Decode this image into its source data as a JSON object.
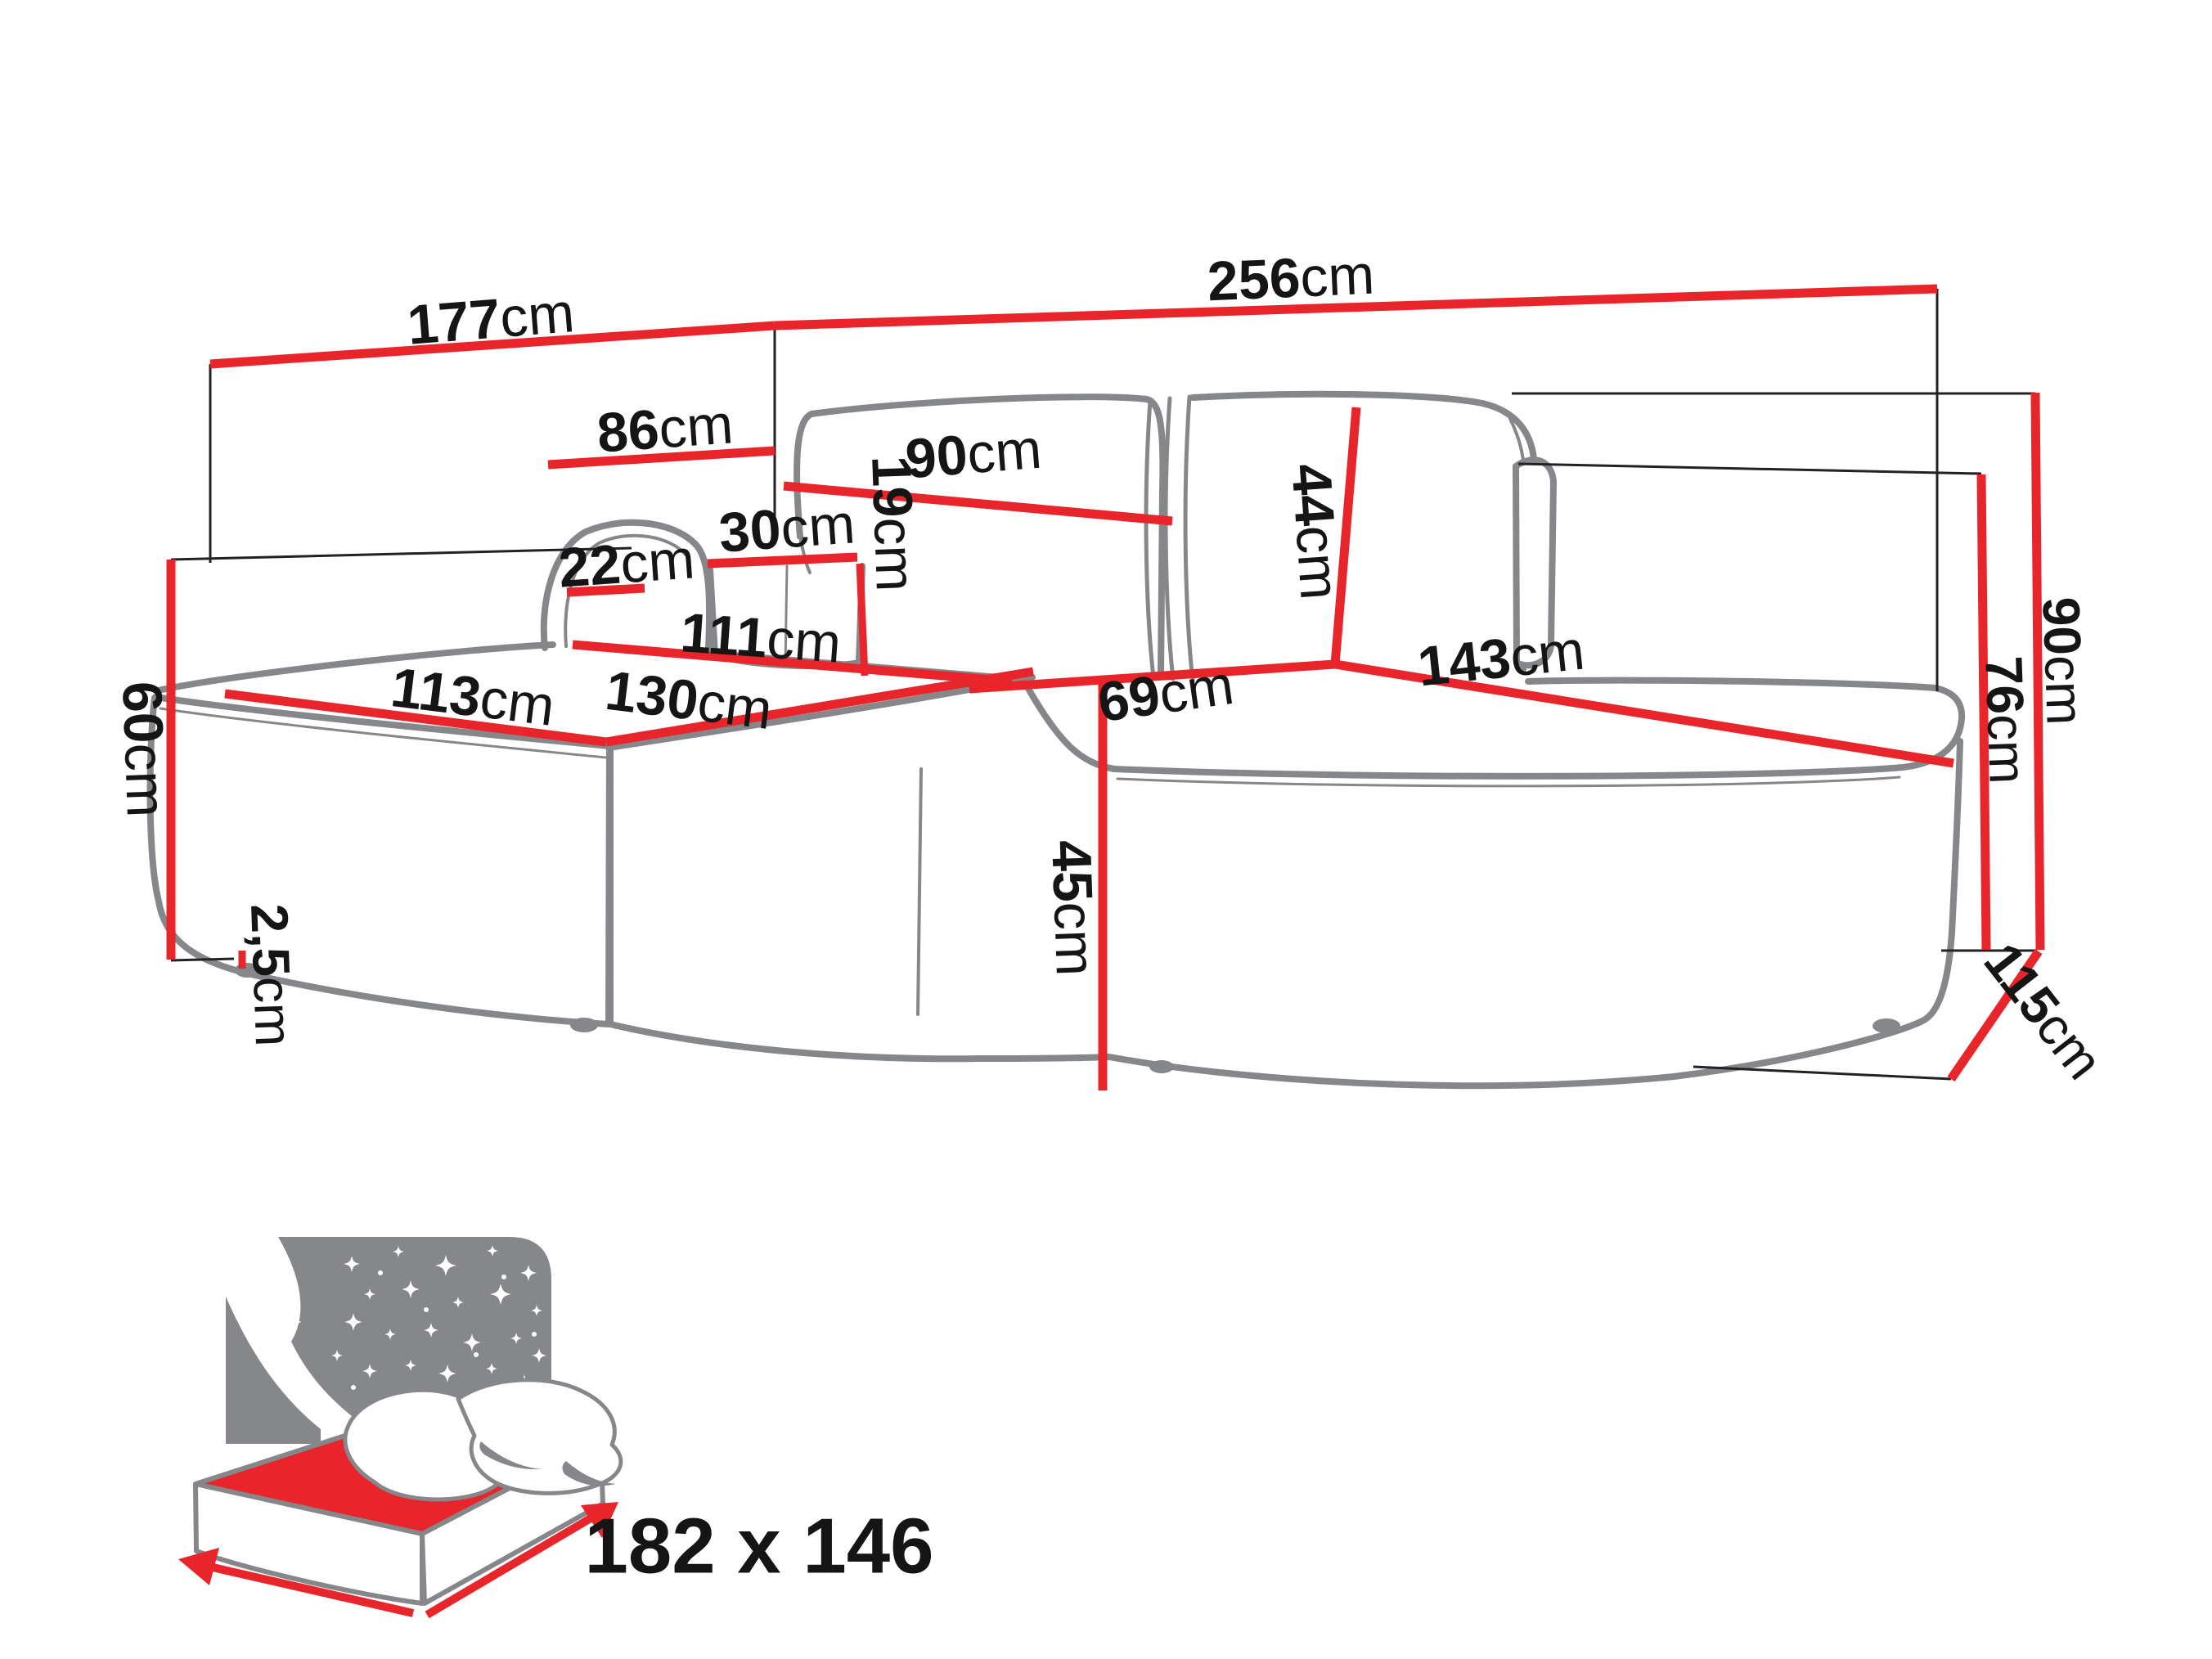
{
  "diagram": {
    "kind": "corner-sofa-dimension-diagram",
    "unit": "cm",
    "colors": {
      "dimension_red": "#e8252a",
      "outline_gray": "#85878a",
      "reference_black": "#222222",
      "label_black": "#151515",
      "icon_gray": "#85878a",
      "background": "#ffffff"
    },
    "dims": [
      {
        "id": "back-width-left",
        "value": "177",
        "unit": "cm"
      },
      {
        "id": "back-width-right",
        "value": "256",
        "unit": "cm"
      },
      {
        "id": "chaise-back-width",
        "value": "86",
        "unit": "cm"
      },
      {
        "id": "backrest-cushion-width",
        "value": "90",
        "unit": "cm"
      },
      {
        "id": "pouf-width",
        "value": "30",
        "unit": "cm"
      },
      {
        "id": "armrest-width",
        "value": "22",
        "unit": "cm"
      },
      {
        "id": "pouf-height",
        "value": "19",
        "unit": "cm"
      },
      {
        "id": "chaise-seat-length",
        "value": "111",
        "unit": "cm"
      },
      {
        "id": "chaise-seat-width",
        "value": "113",
        "unit": "cm"
      },
      {
        "id": "chaise-front-length",
        "value": "130",
        "unit": "cm"
      },
      {
        "id": "corner-seat-width",
        "value": "69",
        "unit": "cm"
      },
      {
        "id": "backrest-height",
        "value": "44",
        "unit": "cm"
      },
      {
        "id": "right-seat-width",
        "value": "143",
        "unit": "cm"
      },
      {
        "id": "armrest-height",
        "value": "60",
        "unit": "cm"
      },
      {
        "id": "seat-height",
        "value": "45",
        "unit": "cm"
      },
      {
        "id": "leg-height",
        "value": "2,5",
        "unit": "cm"
      },
      {
        "id": "total-height",
        "value": "90",
        "unit": "cm"
      },
      {
        "id": "side-height",
        "value": "76",
        "unit": "cm"
      },
      {
        "id": "total-depth",
        "value": "115",
        "unit": "cm"
      }
    ],
    "sleeping_area": {
      "label": "182 x 146",
      "width_cm": 182,
      "depth_cm": 146
    }
  }
}
